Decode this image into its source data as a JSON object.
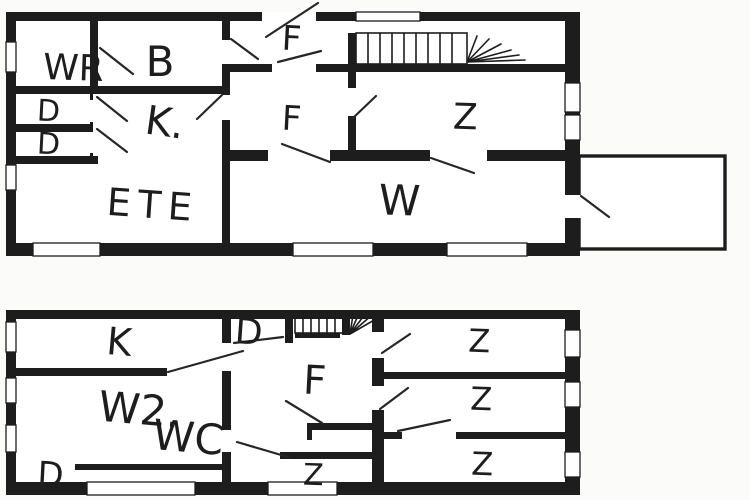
{
  "document": {
    "kind": "floor-plan-drawing",
    "colors": {
      "ink": "#1d1d1d",
      "background": "#fbfbfa",
      "room_fill": "#ffffff"
    }
  },
  "upper_plan": {
    "labels": {
      "wr": "WR",
      "b": "B",
      "f_entry": "F",
      "f_hall": "F",
      "k": "K.",
      "z": "Z",
      "w": "W",
      "ete": "ETE",
      "d_upper": "D",
      "d_lower": "D"
    }
  },
  "lower_plan": {
    "labels": {
      "k": "K",
      "w2": "W2.",
      "wc": "WC",
      "d_left": "D",
      "d_mid": "D",
      "f": "F",
      "z_mid": "Z",
      "z_right_1": "Z",
      "z_right_2": "Z",
      "z_right_3": "Z"
    }
  }
}
